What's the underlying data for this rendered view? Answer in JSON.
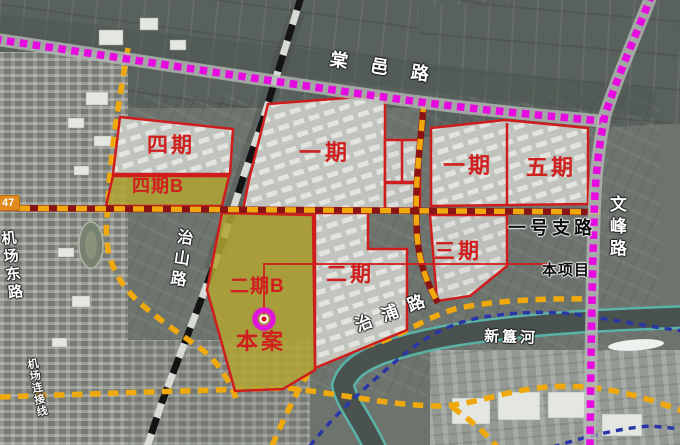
{
  "road_labels": {
    "tangyi": "棠邑路",
    "wenfeng": "文峰路",
    "zhishan": "治山路",
    "jichang_dong": "机场东路",
    "zhipu": "治浦路",
    "yihao_zhilu": "一号支路",
    "airport_link": "机场连接线",
    "route_badge": "47"
  },
  "water_labels": {
    "xingui_river": "新簋河"
  },
  "phase_labels": {
    "phase4": "四期",
    "phase4b": "四期B",
    "phase1_west": "一期",
    "phase1_east": "一期",
    "phase5": "五期",
    "phase2": "二期",
    "phase2b": "二期B",
    "phase3": "三期"
  },
  "project_labels": {
    "site": "本案",
    "project": "本项目"
  },
  "legend_colors": {
    "planned_road_magenta": "#e70ae0",
    "boundary_road_yellow": "#f0a90c",
    "phase_outline_red": "#cf1d1d",
    "railway_black": "#141414",
    "highlight_parcel_olive": "#b1a433",
    "river_edge_teal": "#5ab3a7",
    "river_guide_blue": "#2a36a8"
  }
}
